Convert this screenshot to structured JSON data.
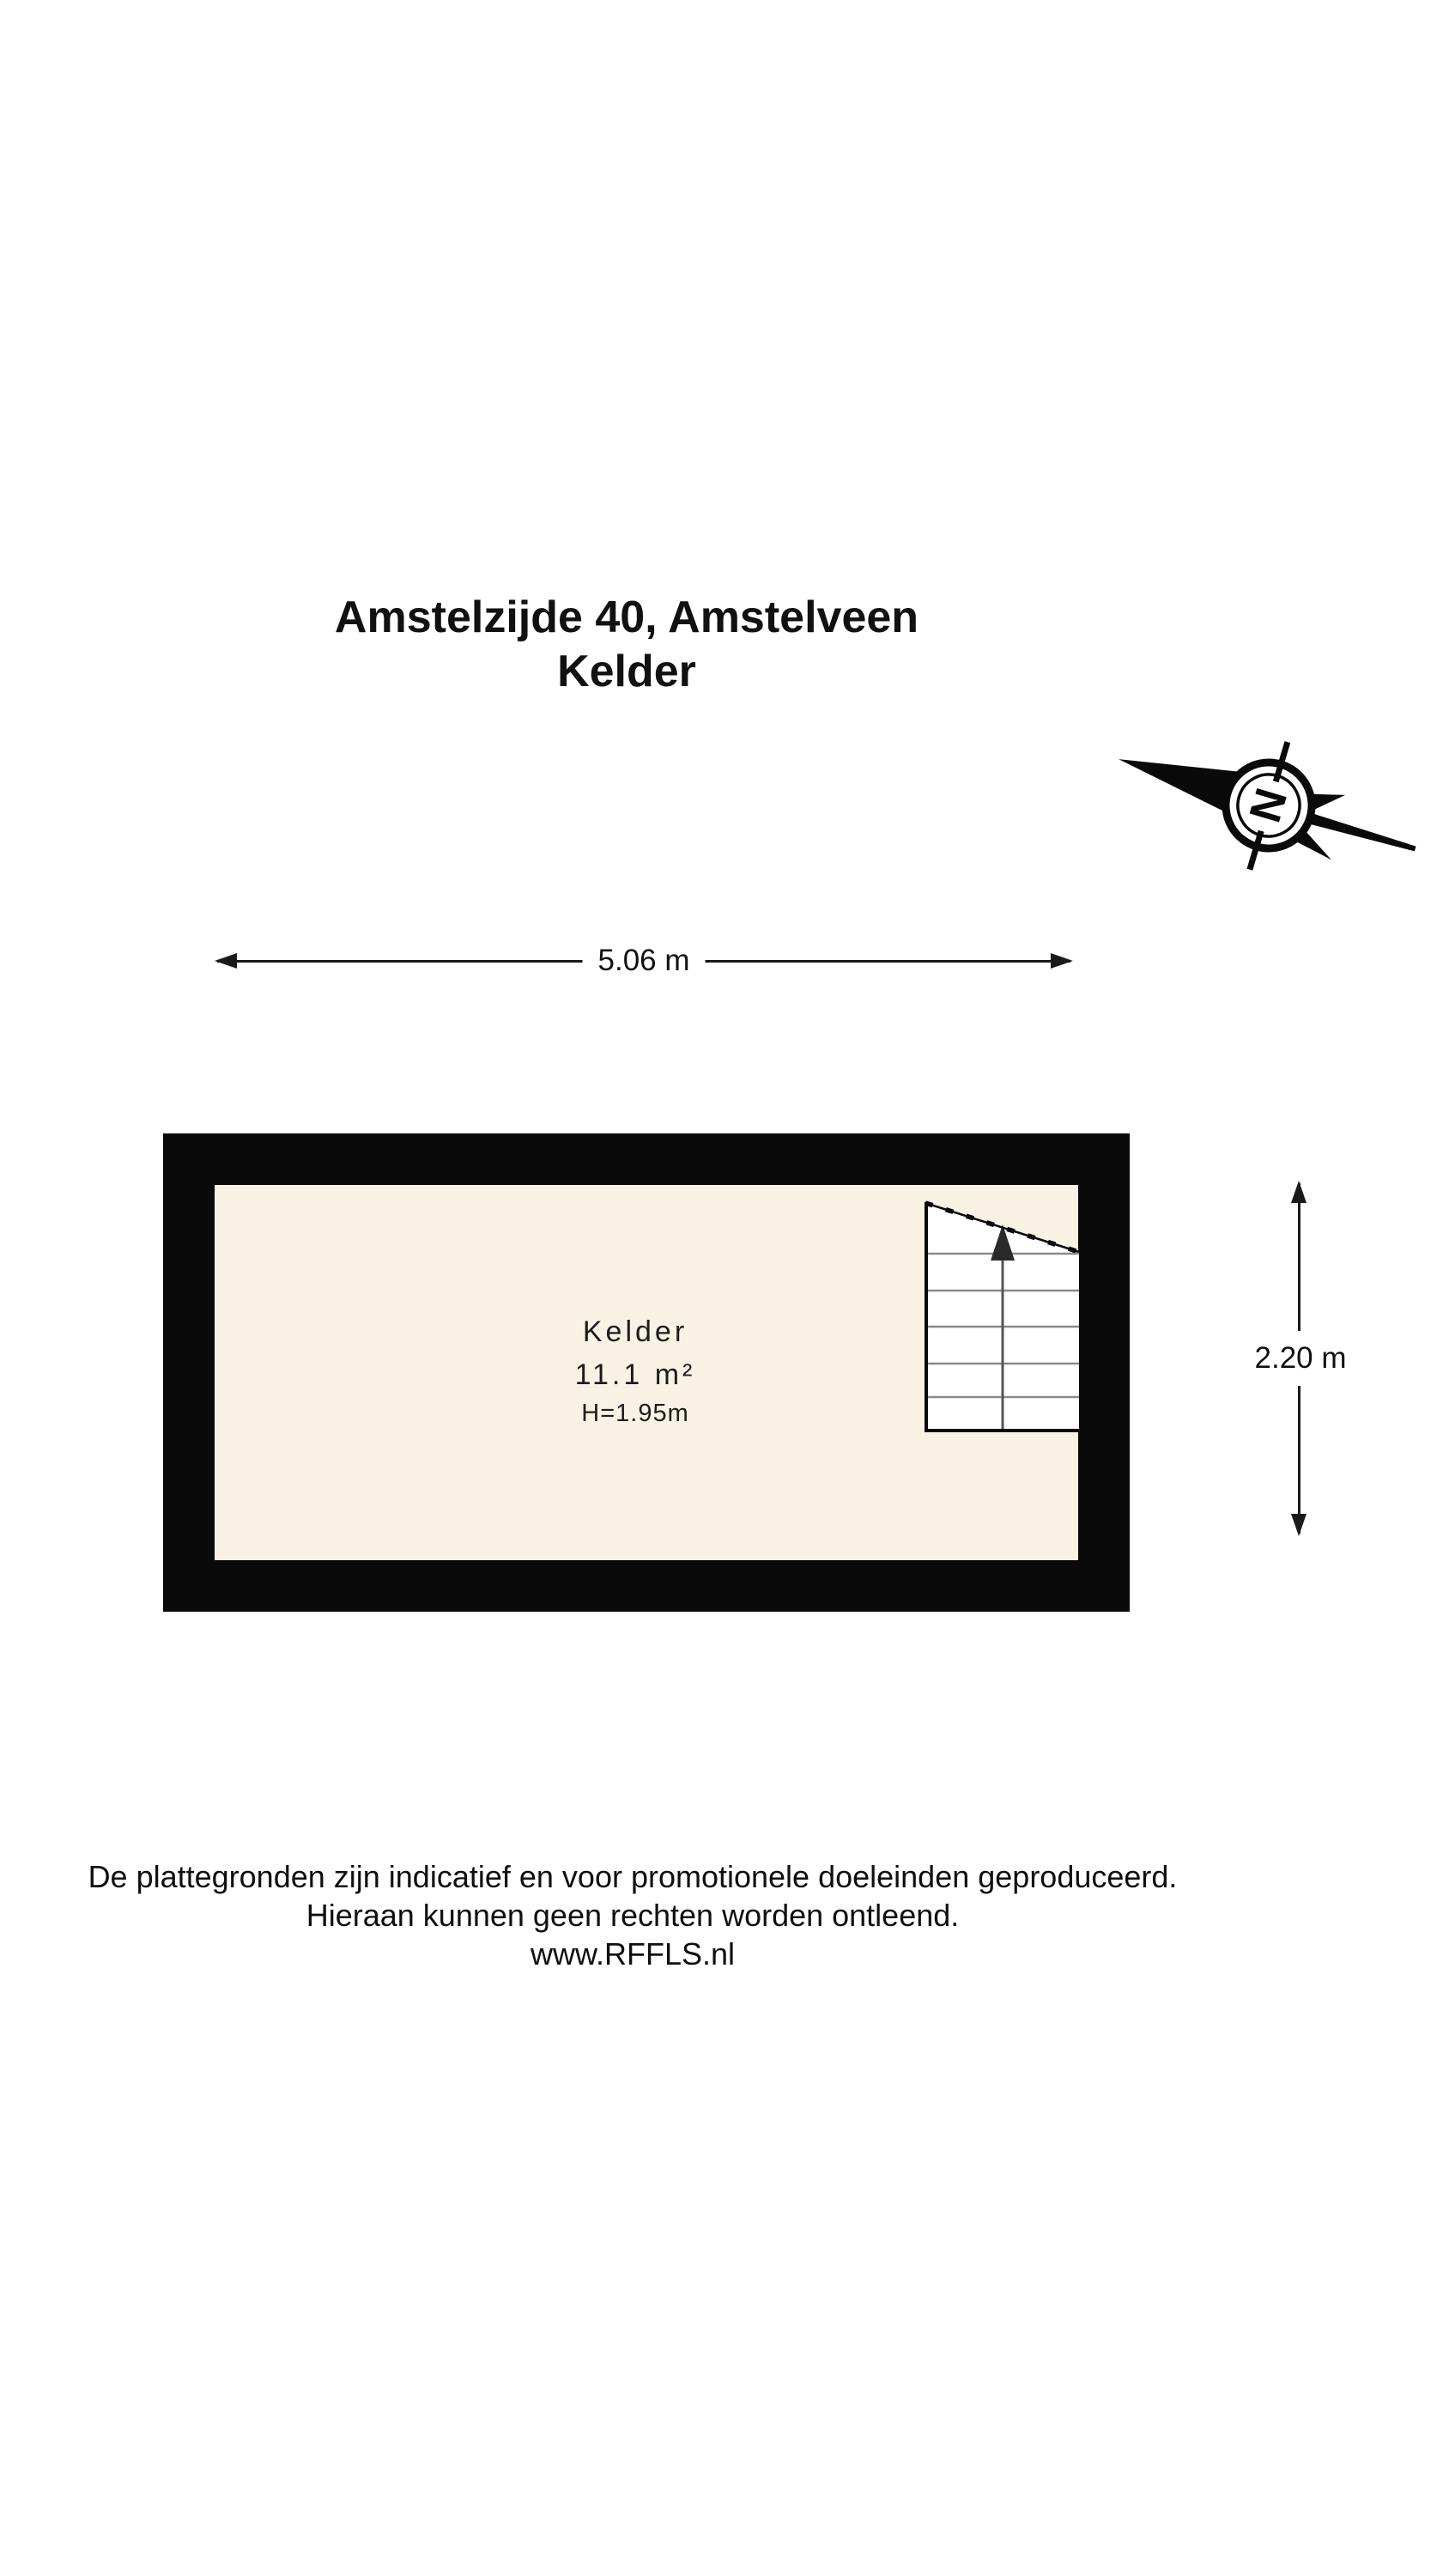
{
  "title": {
    "line1": "Amstelzijde 40, Amstelveen",
    "line2": "Kelder"
  },
  "compass": {
    "label": "N"
  },
  "dimensions": {
    "width_label": "5.06 m",
    "height_label": "2.20 m"
  },
  "room": {
    "name": "Kelder",
    "area": "11.1 m²",
    "ceiling_height": "H=1.95m"
  },
  "footer": {
    "line1": "De plattegronden zijn indicatief en voor promotionele doeleinden geproduceerd.",
    "line2": "Hieraan kunnen geen rechten worden ontleend.",
    "line3": "www.RFFLS.nl"
  },
  "colors": {
    "background": "#ffffff",
    "wall": "#0a0a0a",
    "floor": "#f7f2e4",
    "stair_fill": "#ffffff",
    "step_line": "#8a8a8a",
    "text": "#111111"
  }
}
